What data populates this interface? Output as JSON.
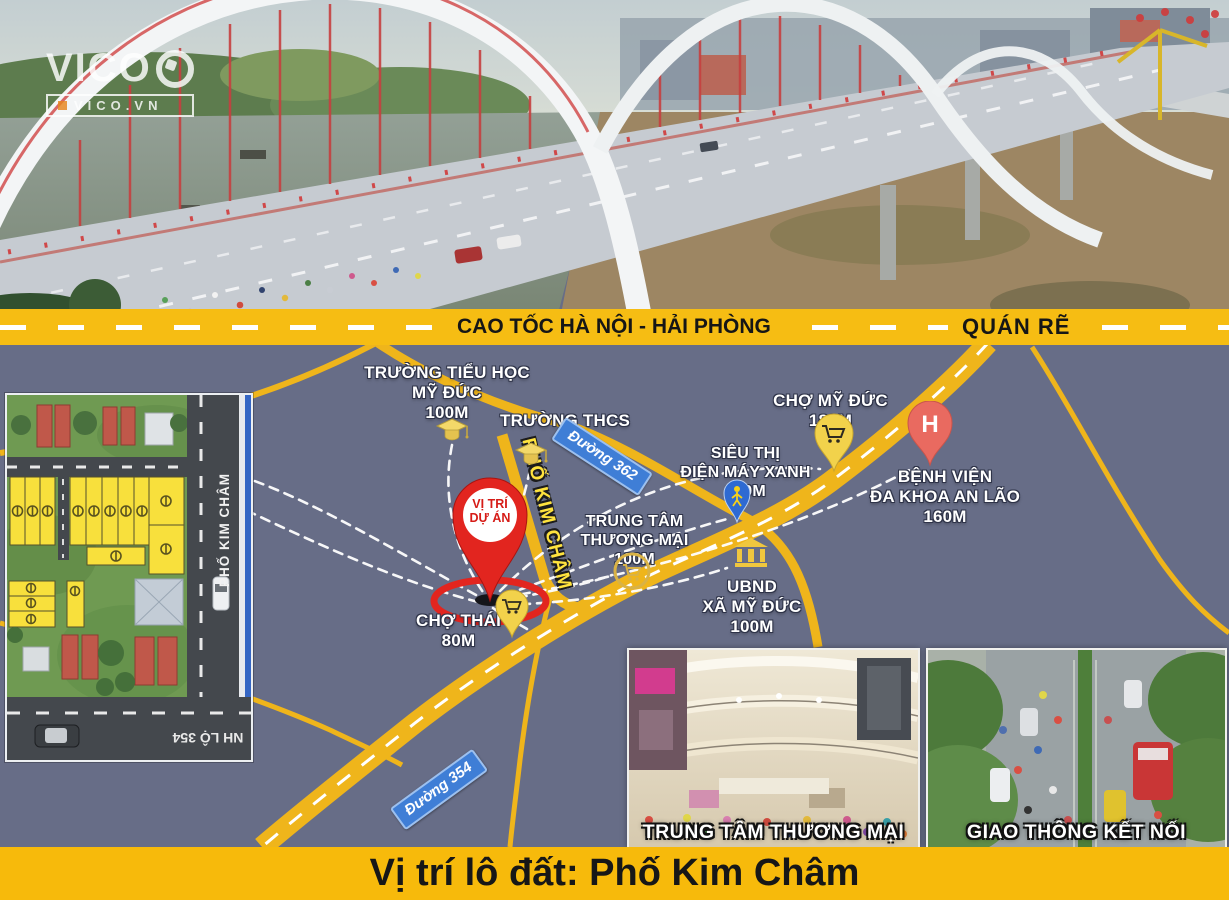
{
  "logo": {
    "brand": "VICO",
    "domain": "VICO.VN"
  },
  "highway": {
    "name": "CAO TỐC HÀ NỘI - HẢI PHÒNG",
    "junction": "QUÁN RẼ"
  },
  "map": {
    "street": "PHỐ KIM CHÂM",
    "project_pin": {
      "line1": "VỊ TRÍ",
      "line2": "DỰ ÁN"
    },
    "hospital_letter": "H",
    "signs": {
      "d362": "Đường 362",
      "d354": "Đường 354"
    },
    "pois": {
      "primary_school": {
        "l1": "TRƯỜNG TIỂU HỌC",
        "l2": "MỸ ĐỨC",
        "l3": "100M"
      },
      "secondary_school": {
        "l1": "TRƯỜNG THCS"
      },
      "market_myduc": {
        "l1": "CHỢ MỸ ĐỨC",
        "l2": "180M"
      },
      "supermarket": {
        "l1": "SIÊU THỊ",
        "l2": "ĐIỆN MÁY XANH",
        "l3": "150M"
      },
      "hospital": {
        "l1": "BỆNH VIỆN",
        "l2": "ĐA KHOA AN LÃO",
        "l3": "160M"
      },
      "mall": {
        "l1": "TRUNG TÂM",
        "l2": "THƯƠNG MẠI",
        "l3": "100M"
      },
      "ubnd": {
        "l1": "UBND",
        "l2": "XÃ MỸ ĐỨC",
        "l3": "100M"
      },
      "market_thai": {
        "l1": "CHỢ THÁI",
        "l2": "80M"
      }
    },
    "inset": {
      "street": "PHỐ KIM CHÂM",
      "road": "NH LỘ 354"
    }
  },
  "photos": {
    "mall_caption": "TRUNG TÂM THƯƠNG MẠI",
    "traffic_caption": "GIAO THÔNG KẾT NỐI"
  },
  "footer": {
    "title": "Vị trí lô đất: Phố Kim Châm"
  },
  "colors": {
    "map_bg": "#676d87",
    "road_yellow": "#f0b71b",
    "band_yellow": "#f6bd13",
    "accent_red": "#e2251f",
    "footer_yellow": "#f7ba0b",
    "sign_blue": "#3f7ed6"
  }
}
